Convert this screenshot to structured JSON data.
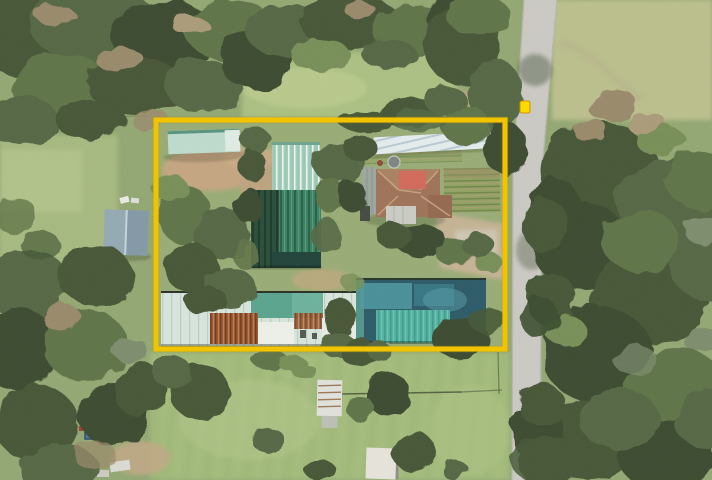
{
  "meta": {
    "type": "aerial-photo",
    "subject": "Aerial view of a rural nursery property with greenhouses, sheds and a house, outlined by a yellow property-boundary overlay beside a vertical road"
  },
  "overlay": {
    "boundary_shape": "rectangle",
    "marker_shape": "small-square-on-road"
  },
  "colors": {
    "boundary": "#F2C400",
    "marker": "#FFD900",
    "road": "#C9C7C1",
    "grassBase": "#90A571",
    "grassLight": "#AFC386",
    "field": "#9DB677",
    "dirt": "#C2A37F",
    "treeDark": "#3C4C30",
    "treeMid": "#546645",
    "ghLight": "#A3CBBA",
    "ghDark": "#3D7F63",
    "shade": "#2B4E3B",
    "silver": "#E2EAEC",
    "mint": "#D6E3DA",
    "rust": "#9A5A36",
    "tealRoof": "#55B0A0",
    "slateRoof": "#2E5A66",
    "houseRoof": "#9C7158",
    "houseRed": "#D0685A",
    "carport": "#C8CAC2",
    "barn": "#92A7B2",
    "paleShed": "#BCD9CC",
    "tarp": "#4F74A8"
  }
}
